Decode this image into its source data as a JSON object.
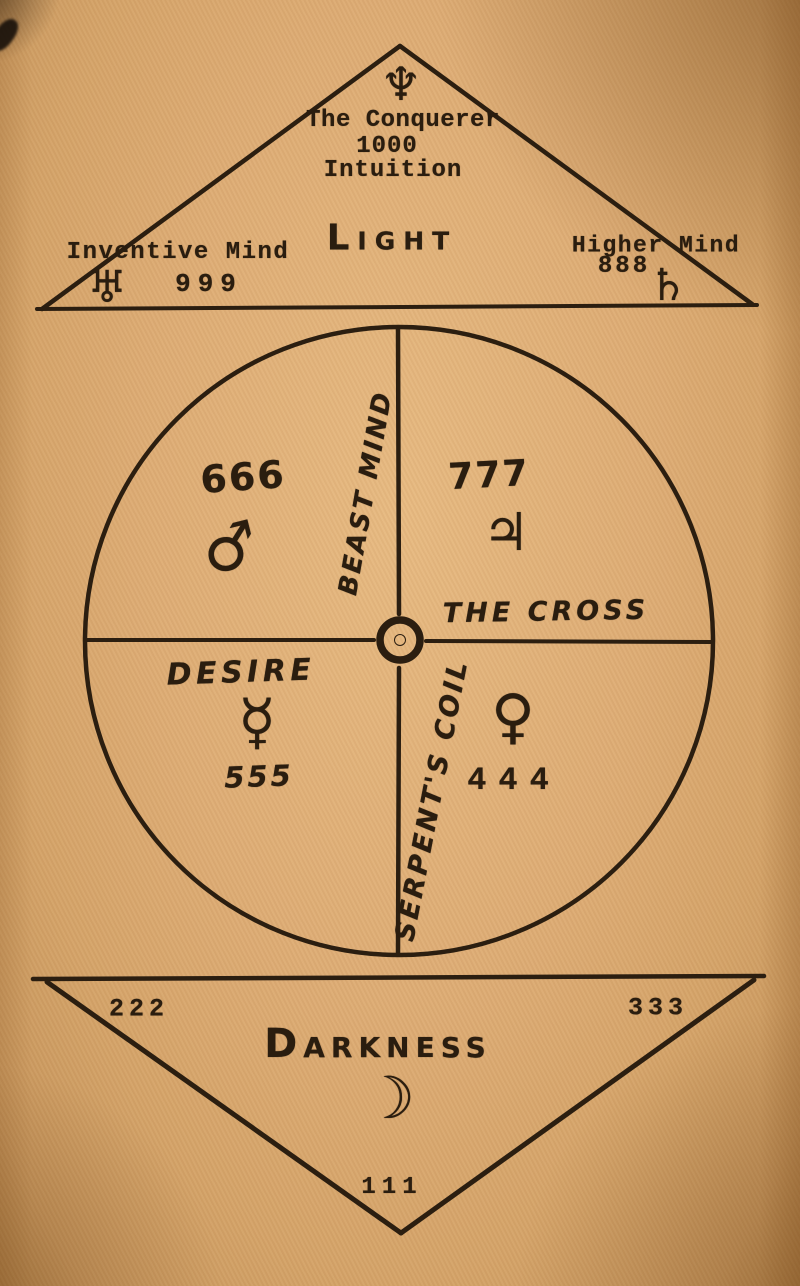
{
  "page": {
    "paper_color": "#dcab74",
    "ink_color": "#2a1d0f",
    "description": "Occult diagram: Light triangle above, quadrant circle center, inverted Darkness triangle below"
  },
  "light_triangle": {
    "apex_symbol": {
      "name": "neptune",
      "glyph": "♆"
    },
    "title": "The Conquerer",
    "number": "1000",
    "subtitle": "Intuition",
    "label": "LIGHT",
    "left_region": {
      "label": "Inventive Mind",
      "number": "999",
      "symbol": {
        "name": "uranus",
        "glyph": "♅"
      }
    },
    "right_region": {
      "label": "Higher Mind",
      "number": "888",
      "symbol": {
        "name": "saturn",
        "glyph": "♄"
      }
    }
  },
  "circle": {
    "center_symbol": {
      "name": "sun",
      "glyph": "☉"
    },
    "vertical_axis_upper_label": "BEAST MIND",
    "vertical_axis_lower_label": "SERPENT'S COIL",
    "horizontal_axis_label": "THE CROSS",
    "quadrant_top_left": {
      "number": "666",
      "symbol": {
        "name": "mars",
        "glyph": "♂"
      }
    },
    "quadrant_top_right": {
      "number": "777",
      "symbol": {
        "name": "jupiter",
        "glyph": "♃"
      }
    },
    "quadrant_bottom_left": {
      "label": "DESIRE",
      "number": "555",
      "symbol": {
        "name": "mercury",
        "glyph": "☿"
      }
    },
    "quadrant_bottom_right": {
      "number": "444",
      "symbol": {
        "name": "venus",
        "glyph": "♀"
      }
    }
  },
  "darkness_triangle": {
    "left_number": "222",
    "right_number": "333",
    "label": "DARKNESS",
    "symbol": {
      "name": "crescent-moon",
      "glyph": "☽"
    },
    "bottom_number": "111"
  }
}
